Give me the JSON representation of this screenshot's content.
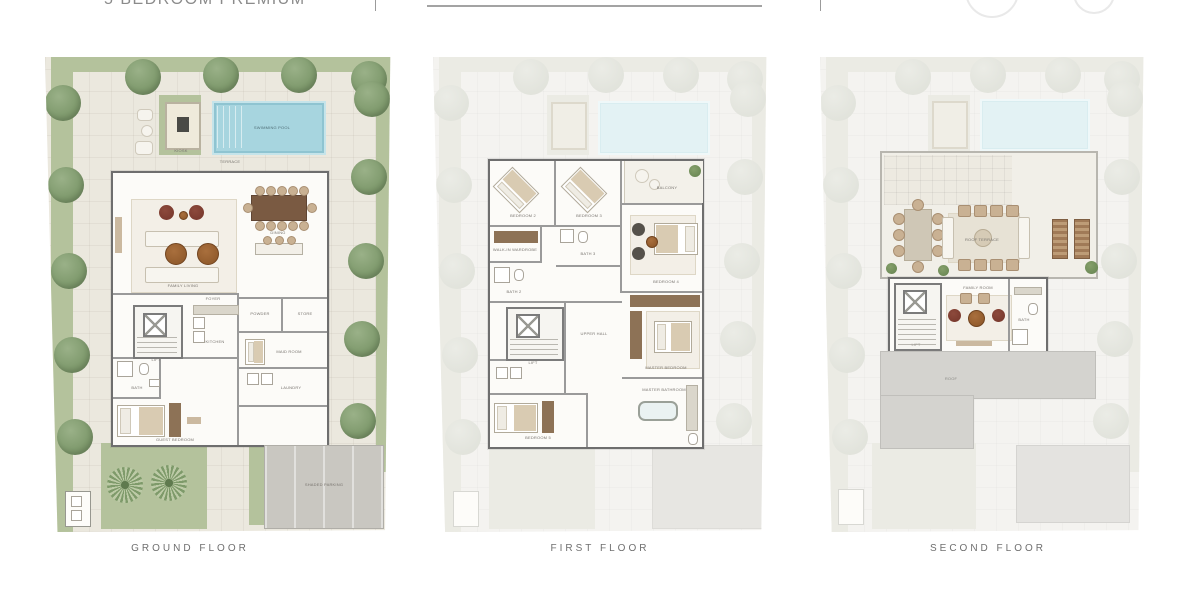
{
  "header": {
    "title": "5 BEDROOM PREMIUM"
  },
  "palette": {
    "landscape_green": "#b4c29c",
    "tree_green": "#7f9a6d",
    "pool_blue": "#a7d5df",
    "paving_beige": "#ebe8de",
    "wall_gray": "#6e6e6e",
    "wood_brown": "#8d7256",
    "accent_red": "#7c3a2e",
    "ghost_gray": "#f4f3f0",
    "caption_gray": "#6f6f6f"
  },
  "plans": {
    "ground": {
      "caption": "GROUND FLOOR",
      "labels": {
        "pool": "SWIMMING POOL",
        "terrace": "TERRACE",
        "kiosk": "KIOSK",
        "living": "FAMILY LIVING",
        "dining": "DINING",
        "kitchen": "KITCHEN",
        "foyer": "FOYER",
        "lift": "LIFT",
        "powder": "POWDER",
        "store": "STORE",
        "maid": "MAID ROOM",
        "laundry": "LAUNDRY",
        "bath": "BATH",
        "guest": "GUEST BEDROOM",
        "parking": "SHADED PARKING"
      }
    },
    "first": {
      "caption": "FIRST FLOOR",
      "labels": {
        "bedroom2": "BEDROOM 2",
        "bedroom3": "BEDROOM 3",
        "bedroom4": "BEDROOM 4",
        "bedroom5": "BEDROOM 5",
        "master": "MASTER BEDROOM",
        "walkin": "WALK-IN WARDROBE",
        "bath2": "BATH 2",
        "bath3": "BATH 3",
        "masterbath": "MASTER BATHROOM",
        "balcony": "BALCONY",
        "hall": "UPPER HALL",
        "lift": "LIFT"
      }
    },
    "second": {
      "caption": "SECOND FLOOR",
      "labels": {
        "roofterrace": "ROOF TERRACE",
        "family": "FAMILY ROOM",
        "bath": "BATH",
        "lift": "LIFT",
        "roof": "ROOF"
      }
    }
  }
}
